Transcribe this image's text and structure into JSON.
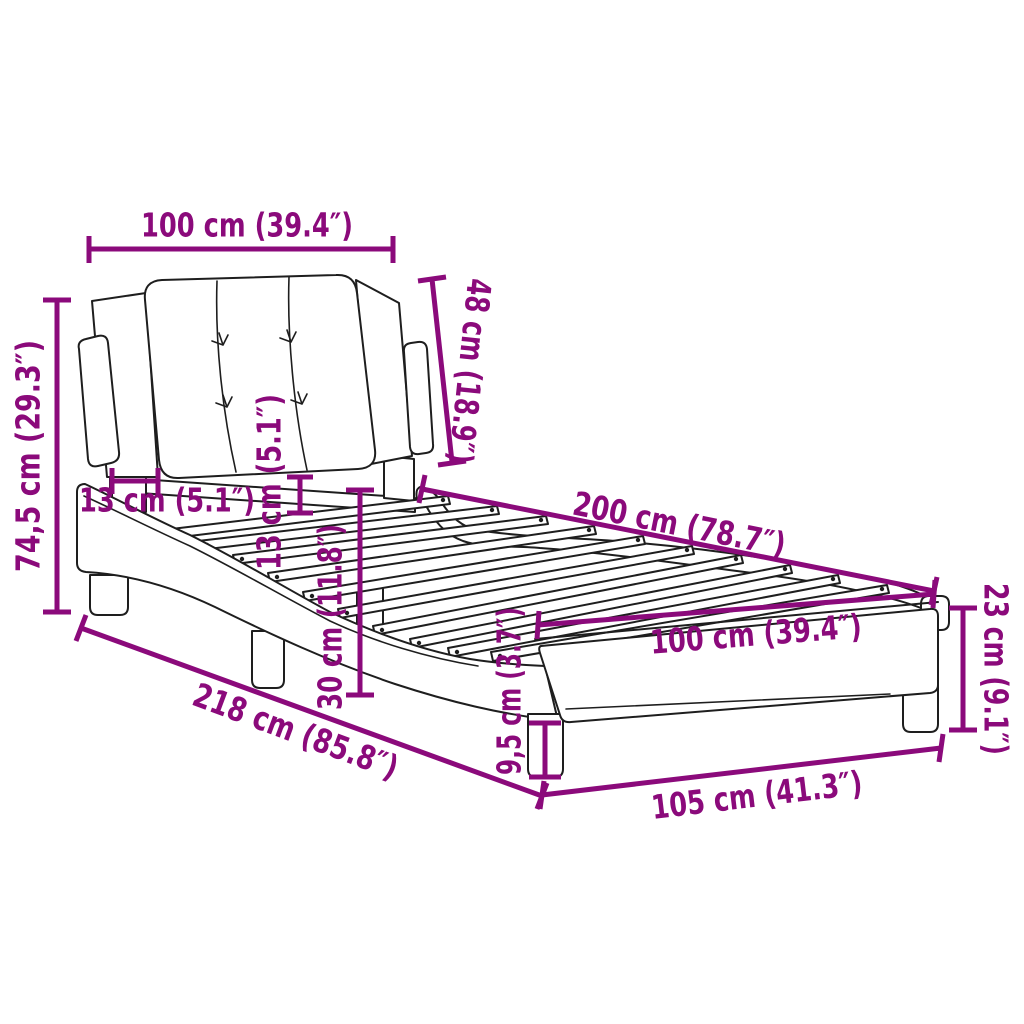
{
  "diagram": {
    "background": "#ffffff",
    "accent_color": "#8B0A7B",
    "line_color": "#1e1e1e",
    "dimensions": [
      {
        "name": "headboard-width",
        "label": "100 cm (39.4″)"
      },
      {
        "name": "headboard-height",
        "label": "48 cm (18.9″)"
      },
      {
        "name": "total-height",
        "label": "74,5 cm (29.3″)"
      },
      {
        "name": "headboard-depth",
        "label": "13 cm (5.1″)"
      },
      {
        "name": "headboard-offset",
        "label": "13 cm (5.1″)"
      },
      {
        "name": "frame-height",
        "label": "30 cm (11.8″)"
      },
      {
        "name": "total-length",
        "label": "218 cm (85.8″)"
      },
      {
        "name": "leg-height",
        "label": "9,5 cm (3.7″)"
      },
      {
        "name": "bed-length",
        "label": "200 cm (78.7″)"
      },
      {
        "name": "bed-width",
        "label": "100 cm (39.4″)"
      },
      {
        "name": "footend-height",
        "label": "23 cm (9.1″)"
      },
      {
        "name": "frame-width",
        "label": "105 cm (41.3″)"
      }
    ]
  }
}
